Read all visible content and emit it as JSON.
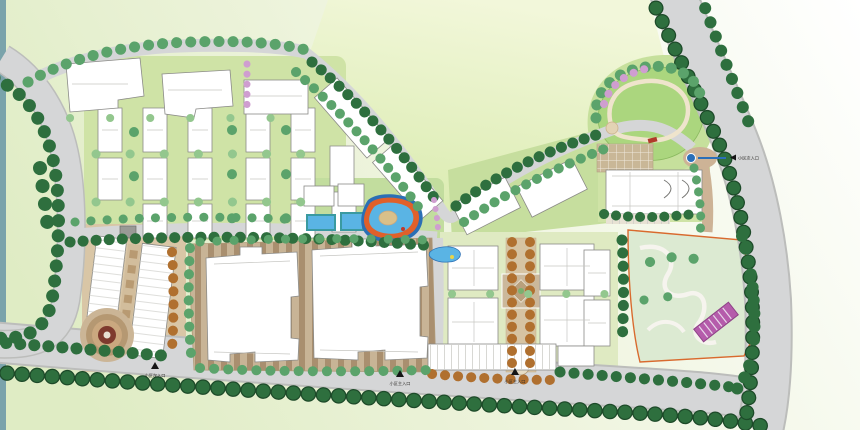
{
  "plan": {
    "markers": {
      "right": {
        "icon": "arrow-left-icon",
        "label": "小区次入口"
      },
      "bottom_left": {
        "icon": "arrow-up-icon",
        "label": "小区次入口"
      },
      "bottom_center": {
        "icon": "arrow-up-icon",
        "label": "小区主入口"
      },
      "bottom_right": {
        "icon": "arrow-up-icon",
        "label": "小区主入口"
      }
    },
    "colors": {
      "background_top": "#ffffff",
      "background_green": "#dfecc4",
      "edge_strip": "#7aa3ab",
      "road": "#d5d6d7",
      "road_edge": "#bcbdbb",
      "sidewalk": "#cdb396",
      "street_tree": "#2e6f3e",
      "street_tree_dark": "#1d4a29",
      "park_tree": "#5ba36b",
      "light_tree": "#93c78e",
      "flower_tree": "#cf9ed0",
      "autumn_tree": "#b0702f",
      "lawn": "#d9ebae",
      "park_lawn": "#abd67e",
      "garden_lawn": "#dcead2",
      "building_fill": "#ffffff",
      "building_stroke": "#8b8b88",
      "pool_water": "#5ab4e4",
      "pool_deep": "#2b6fb5",
      "pool_deck_orange": "#e0602a",
      "lap_pool_frame": "#3a9aa0",
      "plaza_stripe_light": "#c8b496",
      "plaza_stripe_dark": "#a98f6f",
      "axis_paving": "#d6c3a2",
      "pergola": "#b55cab",
      "boundary_line": "#d96a2e",
      "plaza_rings_center": "#7e3a2e",
      "gate_blue": "#2a6fb8"
    }
  }
}
